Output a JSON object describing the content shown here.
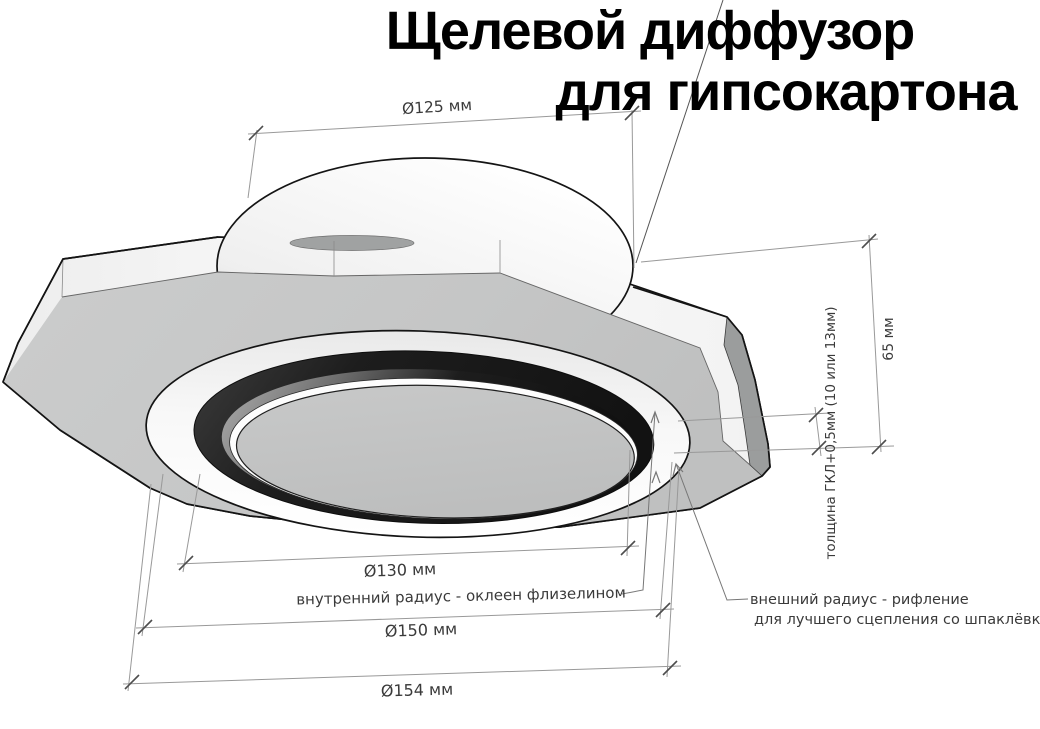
{
  "title": {
    "line1": "Щелевой диффузор",
    "line2": "для гипсокартона"
  },
  "dimensions": {
    "collar_diameter": "Ø125 мм",
    "height": "65 мм",
    "panel_thickness": "толщина ГКЛ+0,5мм (10 или 13мм)",
    "slot_inner_diameter": "Ø130 мм",
    "face_diameter": "Ø150 мм",
    "overall_diameter": "Ø154 мм"
  },
  "annotations": {
    "inner_radius": "внутренний радиус - оклеен флизелином",
    "outer_radius_line1": "внешний радиус - рифление",
    "outer_radius_line2": "для лучшего сцепления со шпаклёвкой"
  },
  "colors": {
    "outline": "#141414",
    "dimension_line": "#999999",
    "tick": "#4d4d4d",
    "plate_face": "#c6c7c7",
    "slot": "#1d1d1d",
    "background": "#ffffff"
  }
}
